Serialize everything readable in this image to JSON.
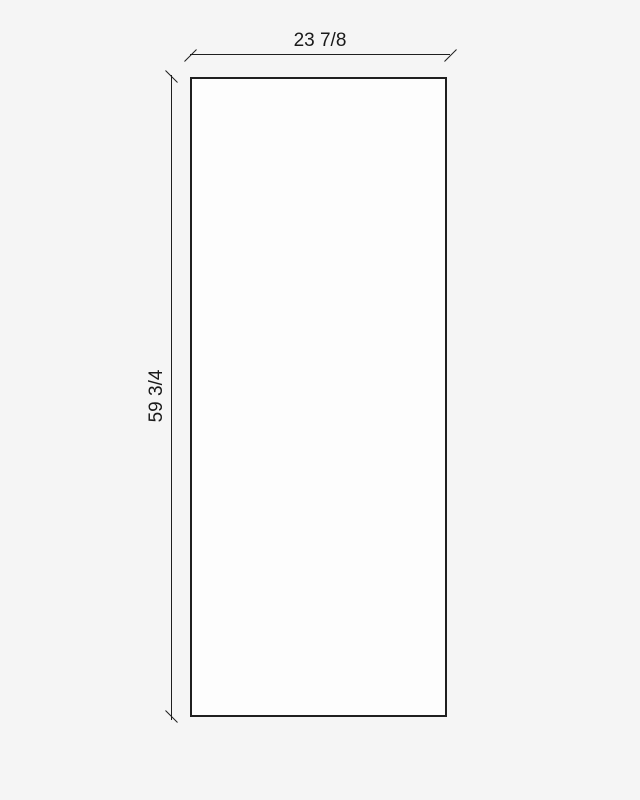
{
  "drawing": {
    "title": "panel-dimension-drawing",
    "width_dimension": {
      "label": "23 7/8",
      "value_inches": 23.875
    },
    "height_dimension": {
      "label": "59 3/4",
      "value_inches": 59.75
    },
    "colors": {
      "background": "#f5f5f5",
      "panel_fill": "#fdfdfd",
      "line": "#1f1f1f",
      "text": "#1a1a1a"
    }
  }
}
